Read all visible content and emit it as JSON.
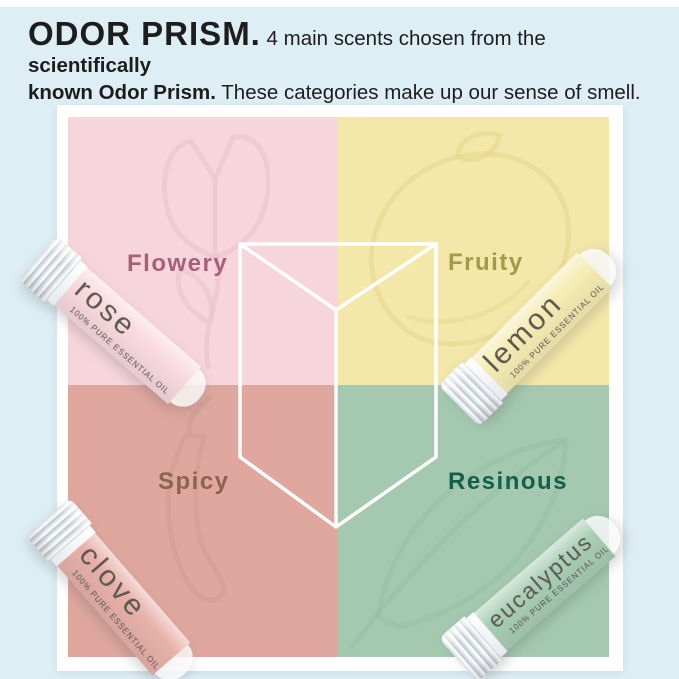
{
  "header": {
    "title": "ODOR PRISM.",
    "segment1": " 4 main scents chosen from the ",
    "segment2": "scientifically",
    "segment3": "known Odor Prism.",
    "segment4": "  These categories make up our sense of smell."
  },
  "diagram": {
    "quadrants": [
      {
        "label": "Flowery",
        "bg": "#f7d5dc",
        "label_color": "#a85f79",
        "watermark": "rose"
      },
      {
        "label": "Fruity",
        "bg": "#f3e8a9",
        "label_color": "#a49a45",
        "watermark": "lemon"
      },
      {
        "label": "Spicy",
        "bg": "#dfa79e",
        "label_color": "#8a6351",
        "watermark": "chili-pepper"
      },
      {
        "label": "Resinous",
        "bg": "#a4c9b0",
        "label_color": "#13604a",
        "watermark": "leaf"
      }
    ],
    "prism_outline_color": "#ffffff"
  },
  "tubes": [
    {
      "name": "rose",
      "subtitle": "100% PURE ESSENTIAL OIL",
      "body_color": "#f9dae0"
    },
    {
      "name": "lemon",
      "subtitle": "100% PURE ESSENTIAL OIL",
      "body_color": "#f6edb4"
    },
    {
      "name": "clove",
      "subtitle": "100% PURE ESSENTIAL OIL",
      "body_color": "#e8b2aa"
    },
    {
      "name": "eucalyptus",
      "subtitle": "100% PURE ESSENTIAL OIL",
      "body_color": "#a9cfb7"
    }
  ],
  "colors": {
    "page_background": "#deeef5",
    "panel_background": "#ffffff",
    "header_text": "#1d1d1d"
  }
}
